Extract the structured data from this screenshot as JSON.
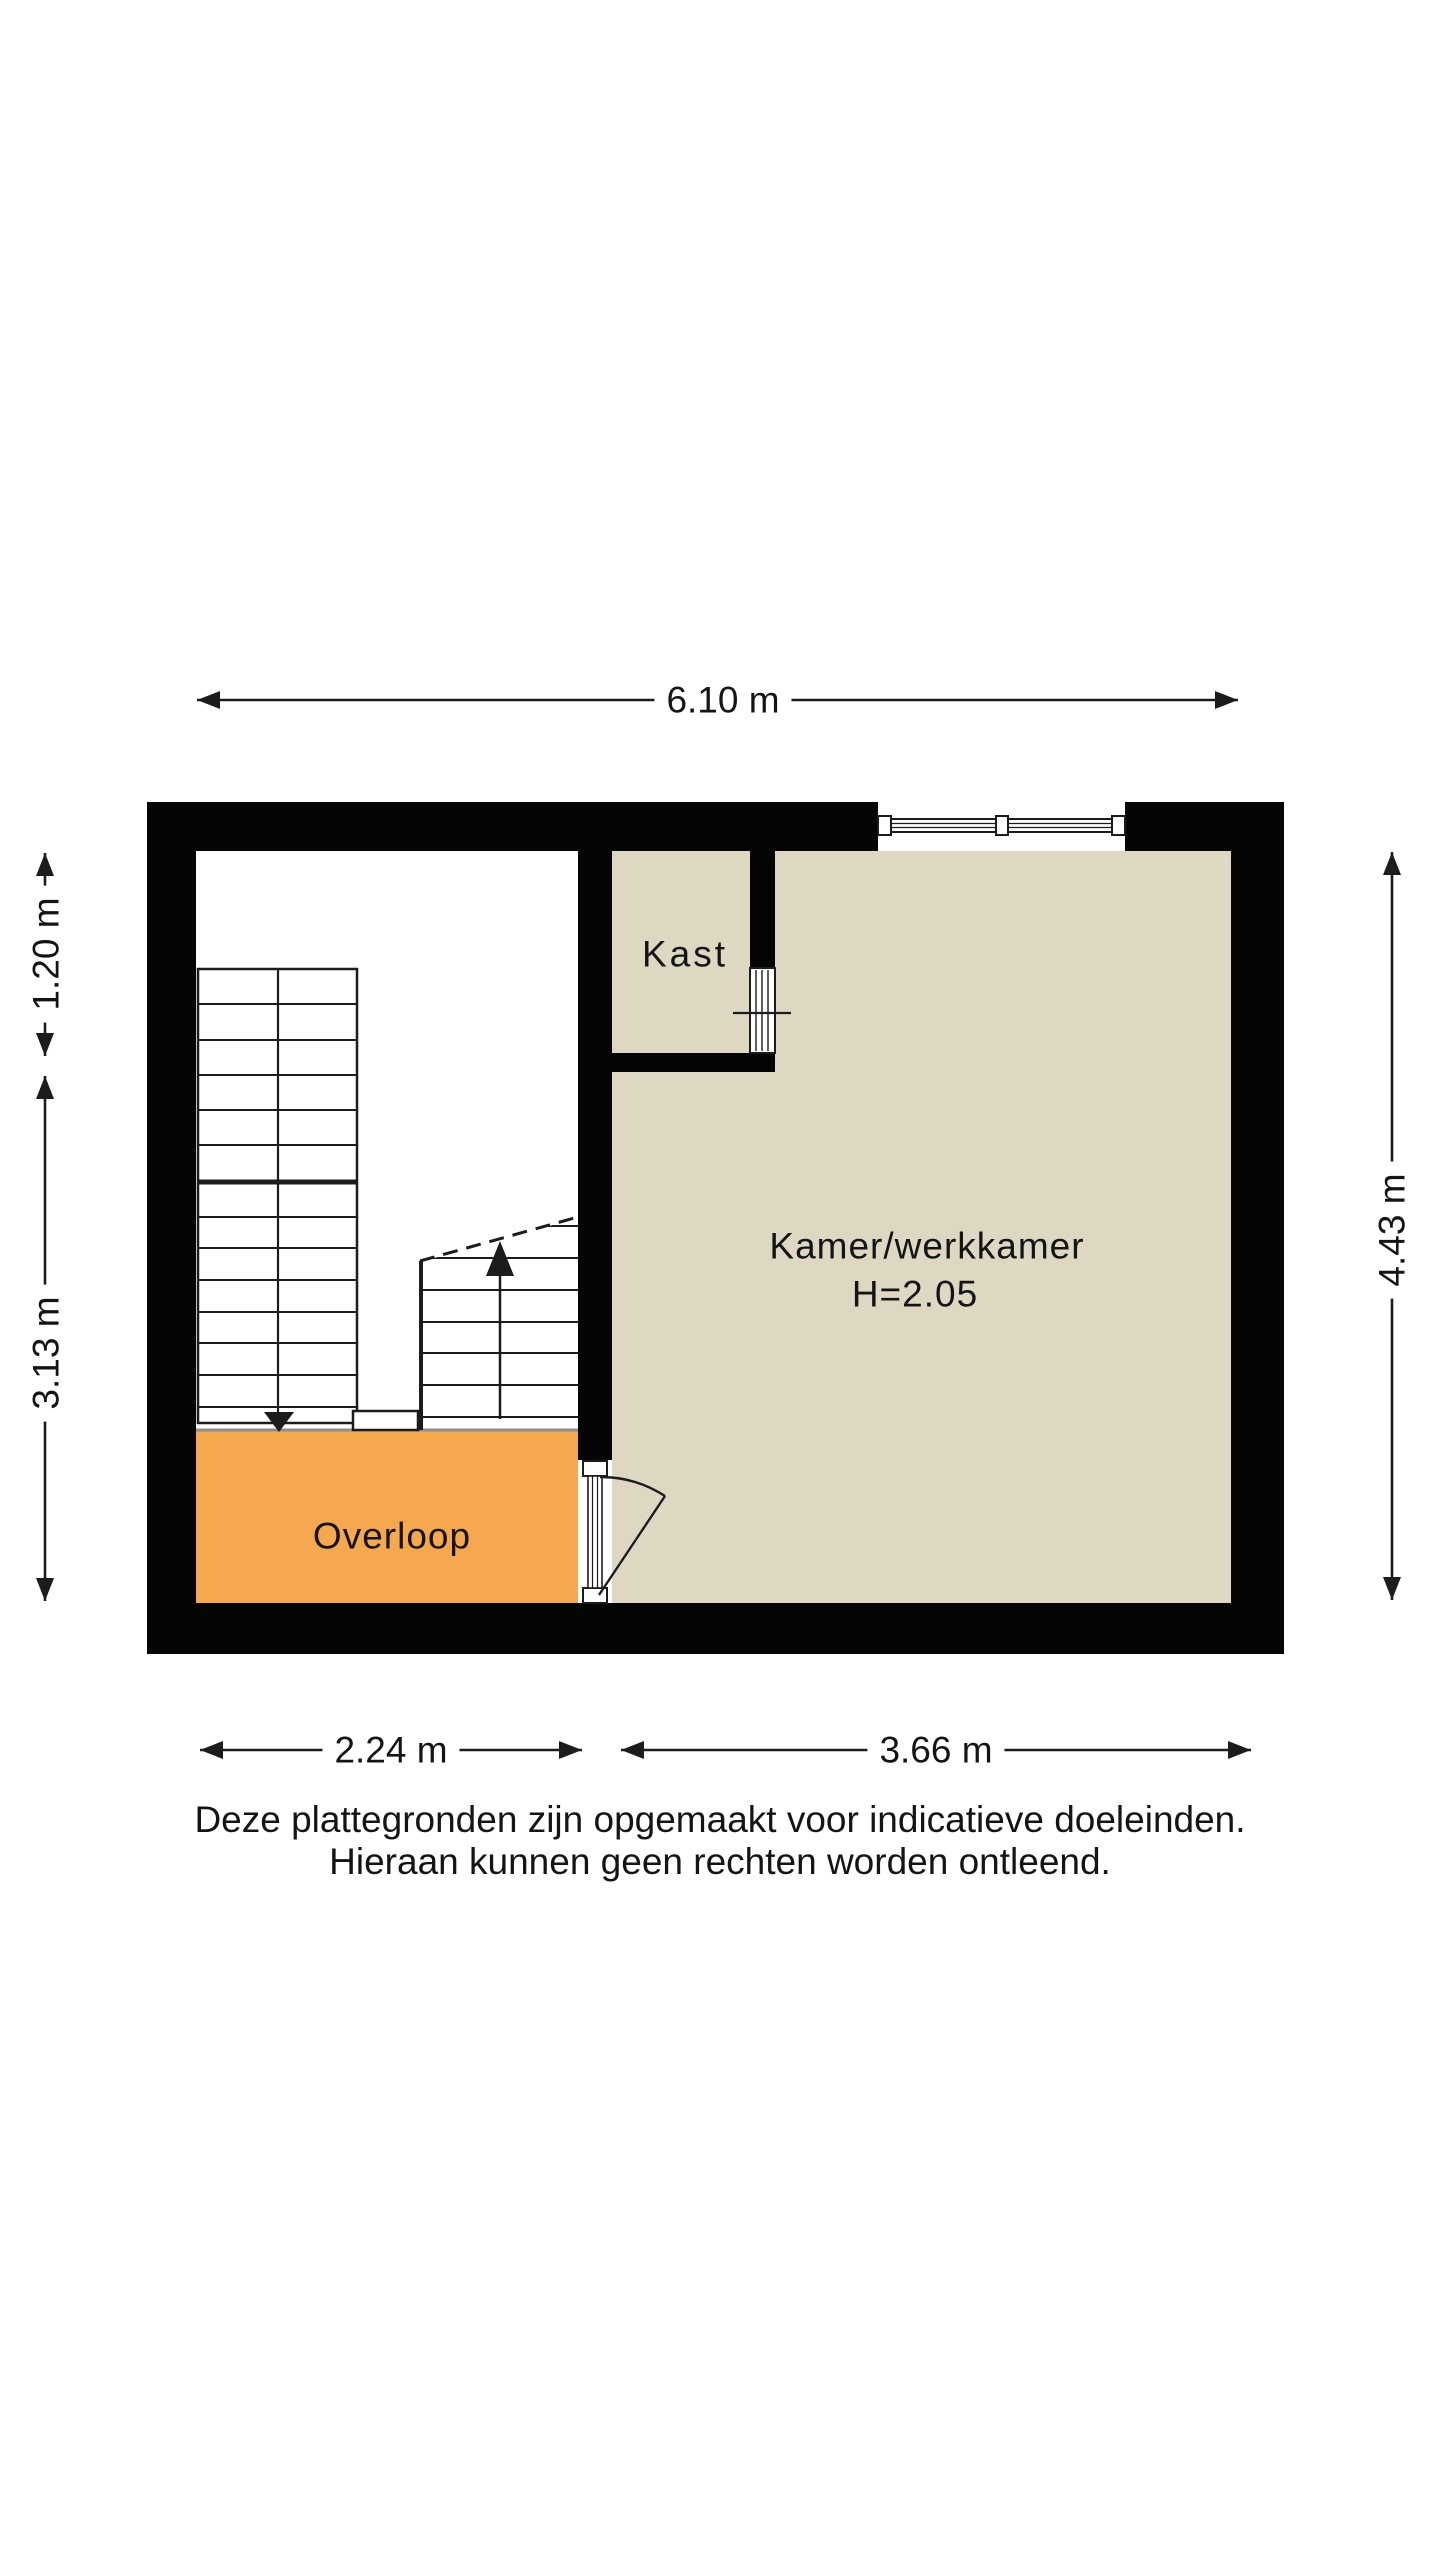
{
  "floorplan": {
    "rooms": {
      "kast": "Kast",
      "kamer": "Kamer/werkkamer",
      "kamer_height": "H=2.05",
      "overloop": "Overloop"
    },
    "dimensions": {
      "top_width": "6.10 m",
      "left_upper": "1.20 m",
      "left_lower": "3.13 m",
      "right_height": "4.43 m",
      "bottom_left": "2.24 m",
      "bottom_right": "3.66 m"
    },
    "disclaimer": {
      "line1": "Deze plattegronden zijn opgemaakt voor indicatieve doeleinden.",
      "line2": "Hieraan kunnen geen rechten worden ontleend."
    },
    "colors": {
      "wall": "#050505",
      "room_fill": "#ded8c3",
      "landing_fill": "#f6a84e",
      "stairwell_fill": "#ffffff",
      "line": "#1c1c1c",
      "landing_edge": "#8e8e8e"
    }
  }
}
